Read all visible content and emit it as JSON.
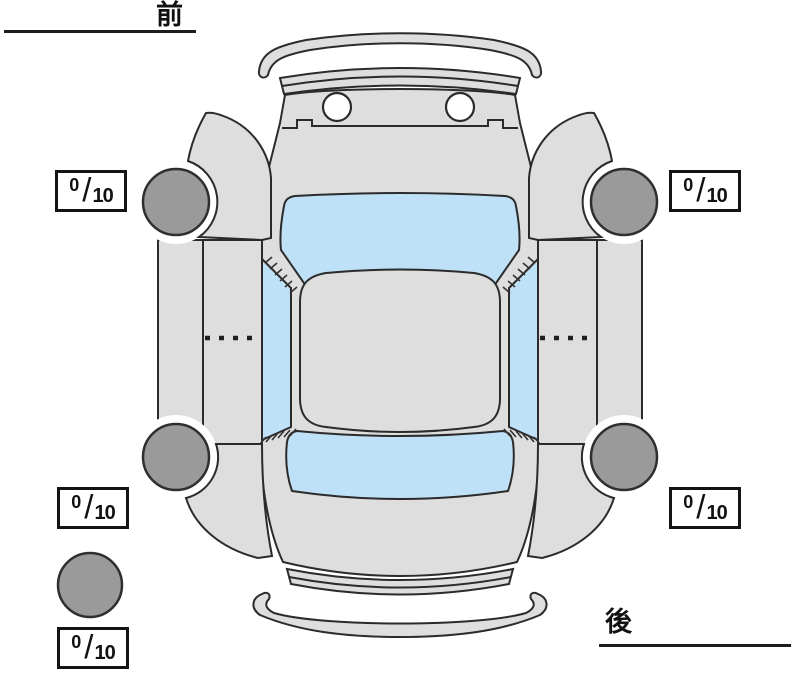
{
  "orientation": {
    "front_label": "前",
    "rear_label": "後"
  },
  "tread_boxes": {
    "separator": "/",
    "front_left": {
      "value": "0",
      "max": "10"
    },
    "front_right": {
      "value": "0",
      "max": "10"
    },
    "rear_left": {
      "value": "0",
      "max": "10"
    },
    "rear_right": {
      "value": "0",
      "max": "10"
    },
    "spare": {
      "value": "0",
      "max": "10"
    }
  },
  "colors": {
    "background": "#ffffff",
    "body": "#dedede",
    "glass": "#bfe1f7",
    "tire": "#9a9a9a",
    "outline": "#2b2b2b",
    "text": "#111111"
  }
}
